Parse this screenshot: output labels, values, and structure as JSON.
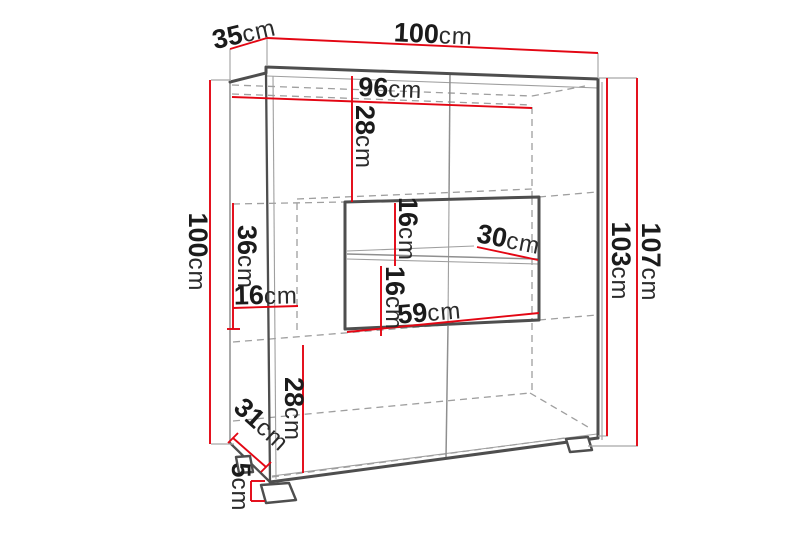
{
  "diagram_type": "furniture-dimension-drawing",
  "colors": {
    "dimension_red": "#e30613",
    "edge_dark": "#4e4e4e",
    "hidden_line_gray": "#9f9f9f",
    "text_ink": "#1b1b1b",
    "background": "#ffffff"
  },
  "labels": {
    "top_width": {
      "value": "100",
      "unit": "cm"
    },
    "top_depth": {
      "value": "35",
      "unit": "cm"
    },
    "inner_width": {
      "value": "96",
      "unit": "cm"
    },
    "top_section_height": {
      "value": "28",
      "unit": "cm"
    },
    "left_height": {
      "value": "100",
      "unit": "cm"
    },
    "middle_section_height": {
      "value": "36",
      "unit": "cm"
    },
    "left_inner_depth": {
      "value": "16",
      "unit": "cm"
    },
    "niche_upper_height": {
      "value": "16",
      "unit": "cm"
    },
    "shelf_depth": {
      "value": "30",
      "unit": "cm"
    },
    "niche_lower_height": {
      "value": "16",
      "unit": "cm"
    },
    "niche_width": {
      "value": "59",
      "unit": "cm"
    },
    "bottom_section_height": {
      "value": "28",
      "unit": "cm"
    },
    "base_depth": {
      "value": "31",
      "unit": "cm"
    },
    "foot_height": {
      "value": "5",
      "unit": "cm"
    },
    "body_height": {
      "value": "103",
      "unit": "cm"
    },
    "total_height": {
      "value": "107",
      "unit": "cm"
    }
  }
}
